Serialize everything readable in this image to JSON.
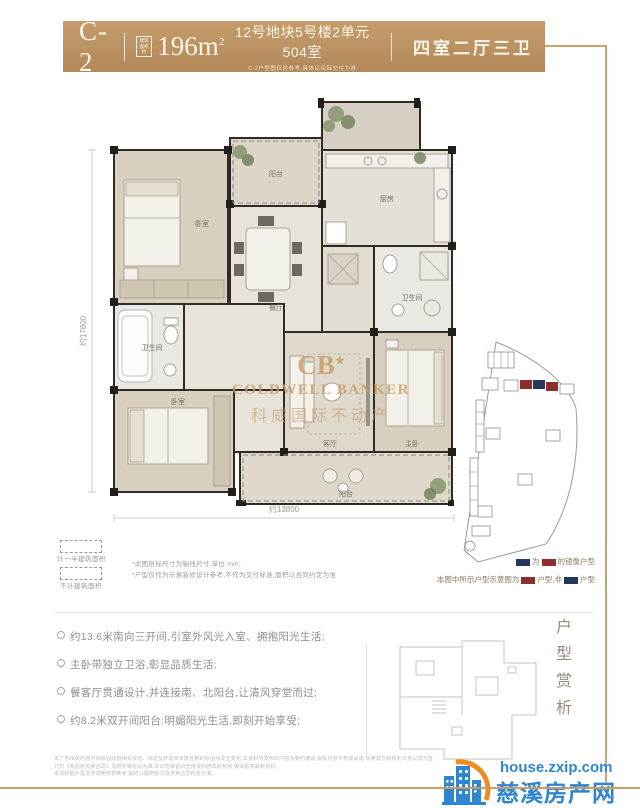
{
  "header": {
    "unit_code": "C-2",
    "area_label_line1": "建筑",
    "area_label_line2": "面积约",
    "area_value": "196m",
    "area_unit_sup": "2",
    "address": "12号地块5号楼2单元504室",
    "address_note": "C-2户型图仅供参考,具体以实际交付为准",
    "room_config": "四室二厅三卫",
    "bar_color": "#b8905f",
    "frame_line_color": "#c9a36f"
  },
  "floorplan": {
    "dim_left": "约17800",
    "dim_bottom": "约13800",
    "rooms": [
      {
        "label": "阳台",
        "x": 208,
        "y": 80
      },
      {
        "label": "厨房",
        "x": 319,
        "y": 105
      },
      {
        "label": "餐厅",
        "x": 208,
        "y": 214
      },
      {
        "label": "卫生间",
        "x": 84,
        "y": 254
      },
      {
        "label": "卧室",
        "x": 134,
        "y": 130
      },
      {
        "label": "卧室",
        "x": 110,
        "y": 308
      },
      {
        "label": "客厅",
        "x": 262,
        "y": 350
      },
      {
        "label": "主卧",
        "x": 344,
        "y": 350
      },
      {
        "label": "卫生间",
        "x": 344,
        "y": 204
      },
      {
        "label": "阳台",
        "x": 278,
        "y": 400
      }
    ],
    "watermark": {
      "logo_text": "CB",
      "logo_star": "★",
      "line1": "COLDWELL BANKER",
      "line2": "科威国际不动产",
      "color": "#c49a63"
    }
  },
  "legend_left": {
    "half_area_label": "计一半建筑面积",
    "no_area_label": "不计建筑面积",
    "note1": "*此图所标尺寸为轴线尺寸,单位:mm;",
    "note2": "*户型仅作为示意装修设计参考,不作为交付标准,面积以合同约定为准"
  },
  "legend_right": {
    "navy_color": "#24355e",
    "red_color": "#8c2c2c",
    "line1_mid": "为",
    "line1_end": "的镜像户型",
    "line2_start": "本图中所示户型示意图为",
    "line2_mid": "户型,非",
    "line2_end": "户型"
  },
  "features": {
    "items": [
      "约13.6米南向三开间,引室外风光入室、拥抱阳光生活;",
      "主卧带独立卫浴,彰显品质生活;",
      "餐客厅贯通设计,并连接南、北阳台,让清风穿堂而过;",
      "约8.2米双开间阳台:明媚阳光生活,即刻开始享受;"
    ]
  },
  "aside": {
    "vertical_title": "户型赏析"
  },
  "disclaimer": {
    "line1": "本广告相关内容不排除因政府相关规划、规定及开发商未能控制的原因而发生变化,本资料所发布的内容为要约邀请,相关内容不构成承诺,买卖双方的权利义务以双方签订的《商品房买卖合同》及附件等协议为准,本公司保留对宣传资料修改的权利,敬请留意最新资料。",
    "line2": "本资料图片及文字说明仅供参考,最终以政府批文及买卖合同约定为准。"
  },
  "footer_brand": {
    "site": "house.zxip.com",
    "name": "慈溪房产网",
    "blue": "#2e86d1",
    "orange": "#f08c1e"
  }
}
